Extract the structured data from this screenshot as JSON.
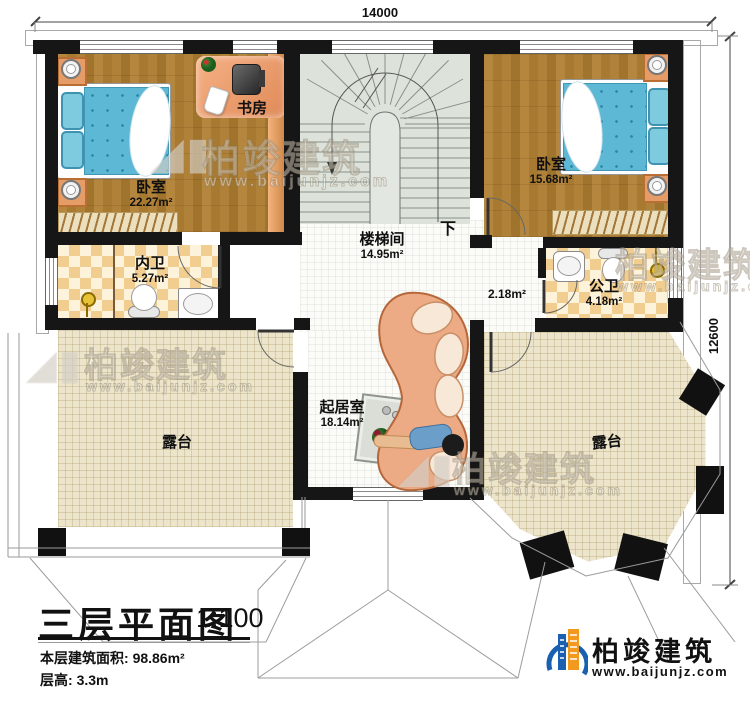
{
  "dimensions": {
    "top_width": "14000",
    "right_height": "12600"
  },
  "rooms": {
    "bedroom_left": {
      "name": "卧室",
      "area": "22.27m²"
    },
    "study": {
      "name": "书房"
    },
    "bath_inner": {
      "name": "内卫",
      "area": "5.27m²"
    },
    "stairwell": {
      "name": "楼梯间",
      "area": "14.95m²",
      "down_label": "下"
    },
    "bedroom_right": {
      "name": "卧室",
      "area": "15.68m²"
    },
    "bath_public": {
      "name": "公卫",
      "area": "4.18m²"
    },
    "corridor": {
      "area": "2.18m²"
    },
    "living": {
      "name": "起居室",
      "area": "18.14m²"
    },
    "terrace_left": {
      "name": "露台"
    },
    "terrace_right": {
      "name": "露台"
    }
  },
  "title_block": {
    "title": "三层平面图",
    "scale": "1:100",
    "area_label": "本层建筑面积:",
    "area_value": "98.86m²",
    "height_label": "层高:",
    "height_value": "3.3m"
  },
  "brand": {
    "name": "柏竣建筑",
    "url": "www.baijunjz.com"
  },
  "watermark": {
    "name": "柏竣建筑",
    "url": "www.baijunjz.com"
  }
}
